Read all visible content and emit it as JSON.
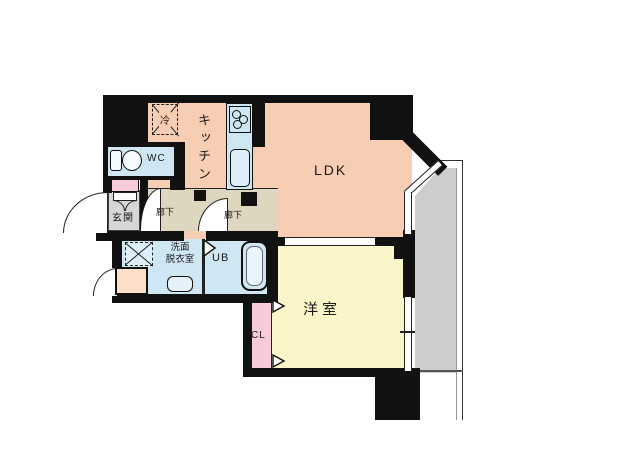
{
  "floorplan": {
    "title": "apartment-floor-plan",
    "labels": {
      "ldk": "LDK",
      "kitchen": "キッチン",
      "wc": "WC",
      "entrance": "玄関",
      "hallway_a": "廊下",
      "hallway_b": "廊下",
      "washroom_line1": "洗面",
      "washroom_line2": "脱衣室",
      "unit_bath": "UB",
      "western_room": "洋室",
      "closet": "CL",
      "refrigerator": "冷"
    },
    "colors": {
      "wall": "#111111",
      "ldk": "#f7cdb4",
      "hall": "#ded7bf",
      "ent": "#d6d6d6",
      "yellow": "#faf6c9",
      "blue": "#cfe6f3",
      "pink": "#f7cbd8",
      "peach": "#fbdfc8",
      "balc": "#cdcdcd",
      "fixture": "#dceef8"
    }
  }
}
